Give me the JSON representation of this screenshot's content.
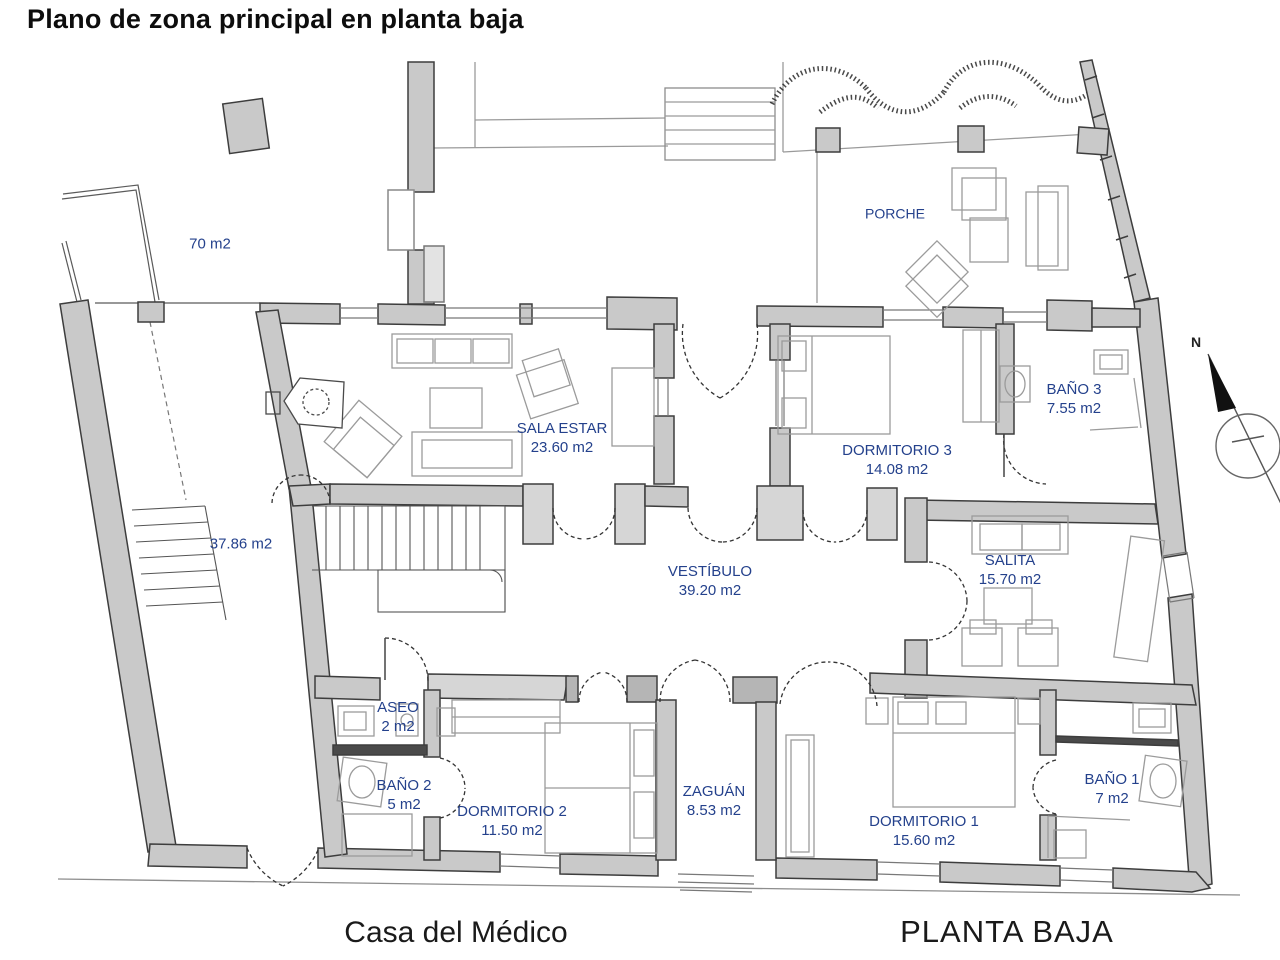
{
  "title": "Plano de zona principal en planta baja",
  "plan": {
    "compass_label": "N",
    "caption_left": "Casa del Médico",
    "caption_right": "PLANTA BAJA"
  },
  "colors": {
    "room_label": "#24418c",
    "wall_gray": "#c9c9c9",
    "wall_light": "#d6d6d6"
  },
  "rooms": [
    {
      "id": "patio-70",
      "name": "",
      "area": "70 m2"
    },
    {
      "id": "porche",
      "name": "PORCHE",
      "area": ""
    },
    {
      "id": "sala-estar",
      "name": "SALA ESTAR",
      "area": "23.60 m2"
    },
    {
      "id": "bano-3",
      "name": "BAÑO 3",
      "area": "7.55 m2"
    },
    {
      "id": "dormitorio-3",
      "name": "DORMITORIO 3",
      "area": "14.08 m2"
    },
    {
      "id": "patio-37",
      "name": "",
      "area": "37.86 m2"
    },
    {
      "id": "vestibulo",
      "name": "VESTÍBULO",
      "area": "39.20 m2"
    },
    {
      "id": "salita",
      "name": "SALITA",
      "area": "15.70 m2"
    },
    {
      "id": "aseo",
      "name": "ASEO",
      "area": "2 m2"
    },
    {
      "id": "bano-2",
      "name": "BAÑO 2",
      "area": "5 m2"
    },
    {
      "id": "dormitorio-2",
      "name": "DORMITORIO 2",
      "area": "11.50 m2"
    },
    {
      "id": "zaguan",
      "name": "ZAGUÁN",
      "area": "8.53 m2"
    },
    {
      "id": "dormitorio-1",
      "name": "DORMITORIO 1",
      "area": "15.60 m2"
    },
    {
      "id": "bano-1",
      "name": "BAÑO 1",
      "area": "7 m2"
    }
  ]
}
